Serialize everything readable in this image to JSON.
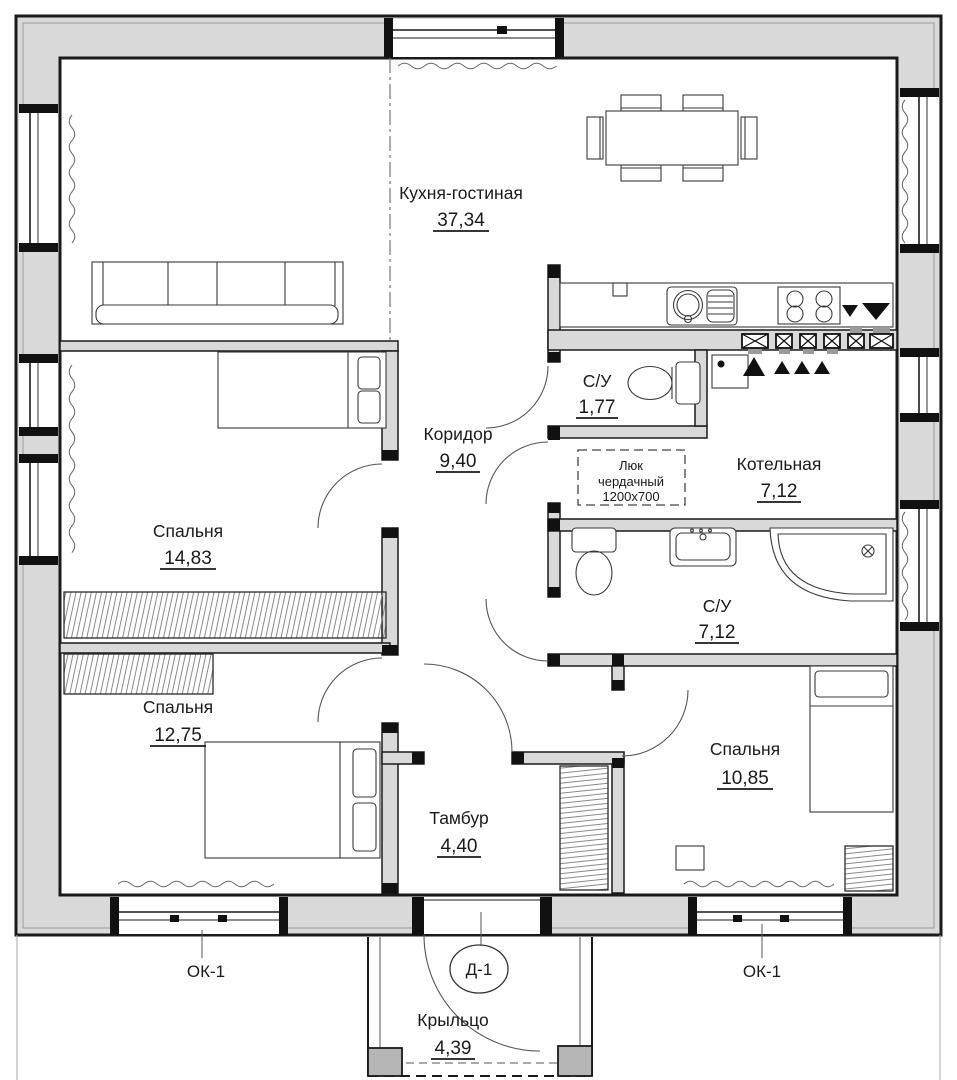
{
  "drawing": {
    "colors": {
      "background": "#ffffff",
      "wall_fill": "#d9d9d9",
      "wall_line": "#1a1a1a",
      "detail_line": "#555555",
      "hatch_line": "#8a8a8a"
    },
    "rooms": [
      {
        "id": "kitchen_living",
        "name": "Кухня-гостиная",
        "area": "37,34"
      },
      {
        "id": "bedroom_1",
        "name": "Спальня",
        "area": "14,83"
      },
      {
        "id": "corridor",
        "name": "Коридор",
        "area": "9,40"
      },
      {
        "id": "wc_small",
        "name": "С/У",
        "area": "1,77"
      },
      {
        "id": "boiler",
        "name": "Котельная",
        "area": "7,12"
      },
      {
        "id": "bathroom",
        "name": "С/У",
        "area": "7,12"
      },
      {
        "id": "bedroom_2",
        "name": "Спальня",
        "area": "12,75"
      },
      {
        "id": "vestibule",
        "name": "Тамбур",
        "area": "4,40"
      },
      {
        "id": "bedroom_3",
        "name": "Спальня",
        "area": "10,85"
      },
      {
        "id": "porch",
        "name": "Крыльцо",
        "area": "4,39"
      }
    ],
    "annotations": {
      "attic_hatch": {
        "line1": "Люк",
        "line2": "чердачный",
        "line3": "1200x700"
      },
      "window_mark_left": "ОК-1",
      "window_mark_right": "ОК-1",
      "door_mark": "Д-1"
    }
  }
}
